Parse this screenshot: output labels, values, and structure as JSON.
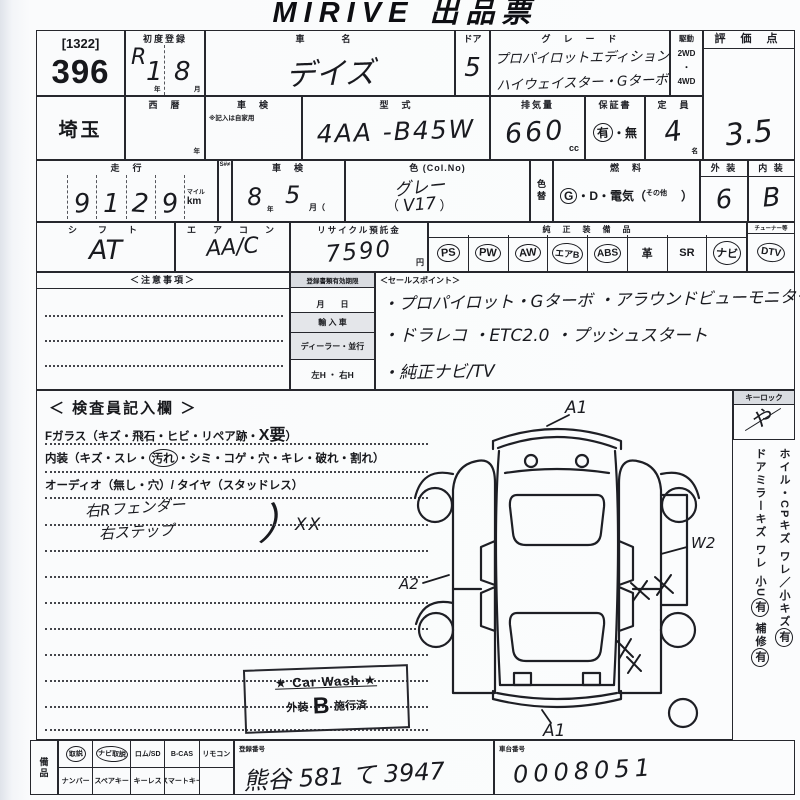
{
  "title": "MIRIVE 出品票",
  "lot": {
    "bracket": "[1322]",
    "number": "396"
  },
  "first_reg": {
    "label": "初度登録",
    "era": "R",
    "year": "1",
    "year_unit": "年",
    "month": "8",
    "month_unit": "月"
  },
  "car_name": {
    "label": "車　名",
    "value": "デイズ"
  },
  "door": {
    "label": "ドア",
    "value": "5"
  },
  "grade": {
    "label": "グ　レ　ー　ド",
    "line1": "プロパイロットエディション",
    "line2": "ハイウェイスター・Gターボ"
  },
  "drive": {
    "label": "駆動",
    "opt1": "2WD",
    "sep": "・",
    "opt2": "4WD"
  },
  "score": {
    "label": "評 価 点",
    "value": "3.5"
  },
  "prefecture": {
    "value": "埼玉"
  },
  "seireki": {
    "label": "西　暦",
    "unit": "年"
  },
  "shaken_col": {
    "label": "車　検",
    "note": "※記入は自家用"
  },
  "model_code": {
    "label": "型　式",
    "value": "4AA -B45W"
  },
  "displacement": {
    "label": "排気量",
    "value": "660",
    "unit": "cc"
  },
  "warranty": {
    "label": "保証書",
    "yes": "有",
    "sep": "・",
    "no": "無"
  },
  "capacity": {
    "label": "定　員",
    "value": "4",
    "unit": "名"
  },
  "mileage": {
    "label": "走　行",
    "s_label": "S#≠",
    "digits": [
      "",
      "9",
      "1",
      "2",
      "9"
    ],
    "unit_top": "マイル",
    "unit_bottom": "km"
  },
  "shaken": {
    "label": "車　検",
    "year": "8",
    "year_unit": "年",
    "month": "5",
    "month_unit": "月（"
  },
  "color": {
    "label": "色 (Col.No)",
    "value": "グレー",
    "paren_open": "（",
    "code": "V17",
    "paren_close": "）"
  },
  "color_change": {
    "label": "色替"
  },
  "fuel": {
    "label": "燃　料",
    "g": "G",
    "mid": "・D・電気（",
    "other": "その他",
    "close": "）"
  },
  "exterior": {
    "label": "外 装",
    "value": "6"
  },
  "interior": {
    "label": "内 装",
    "value": "B"
  },
  "shift": {
    "label": "シ　フ　ト",
    "value": "AT"
  },
  "aircon": {
    "label": "エ　ア　コ　ン",
    "value": "AA/C"
  },
  "recycle": {
    "label": "リサイクル預託金",
    "value": "7590",
    "unit": "円"
  },
  "equipment": {
    "label": "純　正　装　備　品",
    "items": [
      {
        "label": "PS",
        "circled": true
      },
      {
        "label": "PW",
        "circled": true
      },
      {
        "label": "AW",
        "circled": true
      },
      {
        "label": "エアB",
        "circled": true
      },
      {
        "label": "ABS",
        "circled": true
      },
      {
        "label": "革",
        "circled": false
      },
      {
        "label": "SR",
        "circled": false
      },
      {
        "label": "ナビ",
        "circled": true
      }
    ]
  },
  "tuner": {
    "label": "チューナー等",
    "value": "DTV",
    "circled": true
  },
  "notes": {
    "label": "＜注意事項＞"
  },
  "reg_docs": {
    "label": "登録書類有効期限",
    "row1": "月　　日",
    "row2": "輸 入 車",
    "row3": "ディーラー・並行",
    "row4": "左H ・ 右H"
  },
  "sales_points": {
    "label": "＜セールスポイント＞",
    "line1": "・プロパイロット・Gターボ ・アラウンドビューモニター",
    "line2": "・ドラレコ ・ETC2.0 ・プッシュスタート",
    "line3": "・純正ナビ/TV"
  },
  "inspector": {
    "header": "＜ 検査員記入欄 ＞",
    "glass_pre": "Fガラス（キズ・飛石・ヒビ・リペア跡・",
    "glass_mark": "X要",
    "glass_post": "）",
    "interior_pre": "内装（キズ・スレ・",
    "interior_circled": "汚れ",
    "interior_post": "・シミ・コゲ・穴・キレ・破れ・割れ）",
    "audio_line": "オーディオ（無し・穴）/ タイヤ（スタッドレス）",
    "note1": "右Rフェンダー",
    "note2": "右ステップ",
    "brace": "）",
    "note_mark": "XX"
  },
  "car_wash": {
    "line1": "★ Car Wash ★",
    "ext": "外装",
    "grade": "B",
    "done": "施行済"
  },
  "diagram": {
    "a1_top": "A1",
    "a2": "A2",
    "w2": "W2",
    "a1_bottom": "A1"
  },
  "keylock": {
    "label": "キーロック",
    "mark": "や"
  },
  "sidebar": {
    "line1_pre": "ホイル・CPキズ ワレ／小キズ",
    "line1_yes": "有",
    "line2_pre": "ドアミラーキズ ワレ 小U",
    "line2_yes": "有",
    "line2_mid": " 補修",
    "line2_yes2": "有"
  },
  "bottom": {
    "bihin": "備品",
    "row1": [
      {
        "label": "取説",
        "circled": true
      },
      {
        "label": "ナビ取説",
        "circled": true
      },
      {
        "label": "ロム/SD",
        "circled": false
      },
      {
        "label": "B-CAS",
        "circled": false
      },
      {
        "label": "リモコン",
        "circled": false
      }
    ],
    "row2": [
      {
        "label": "ナンバー",
        "circled": false
      },
      {
        "label": "スペアキー",
        "circled": false
      },
      {
        "label": "キーレス",
        "circled": false
      },
      {
        "label": "スマートキー",
        "circled": false
      },
      {
        "label": "",
        "circled": false
      }
    ],
    "reg_no": {
      "label": "登録番号",
      "value": "熊谷 581 て 3947"
    },
    "chassis": {
      "label": "車台番号",
      "value": "0008051"
    }
  }
}
